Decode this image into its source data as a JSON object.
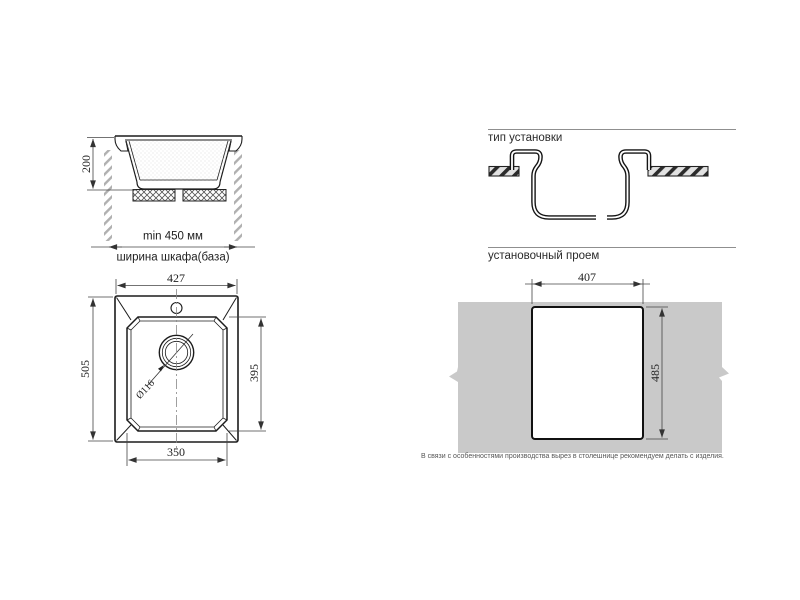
{
  "colors": {
    "countertop_gray": "#c9c9c9",
    "outline_dark": "#1c1c1c",
    "dimension_line": "#444444",
    "cabinet_hatch": "#b0b0b0",
    "header_rule": "#8f8f8f"
  },
  "cross_section": {
    "bowl_height": "200",
    "cabinet_min_width": "min 450 мм",
    "cabinet_width_label": "ширина шкафа(база)"
  },
  "top_view": {
    "overall_width": "427",
    "overall_depth": "505",
    "bowl_length": "395",
    "bowl_width": "350",
    "drain_diameter": "Ø116"
  },
  "installation_type": {
    "title": "тип установки"
  },
  "installation_opening": {
    "title": "установочный проем",
    "cutout_width": "407",
    "cutout_height": "485"
  },
  "footer_note": "В связи с особенностями производства вырез в столешнице рекомендуем делать с изделия."
}
